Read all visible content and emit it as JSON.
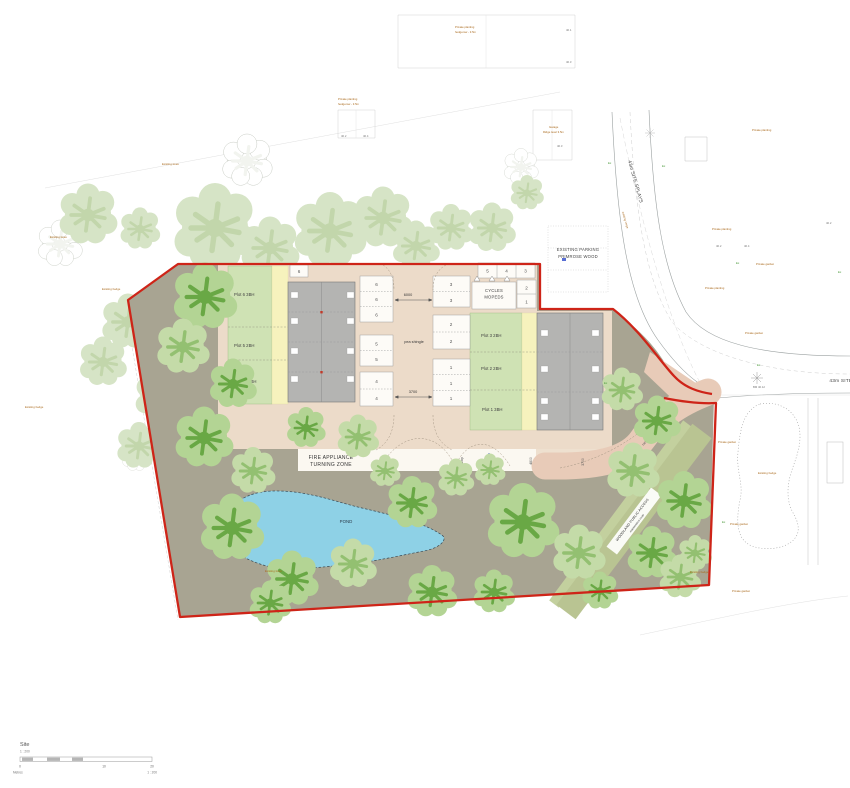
{
  "plan": {
    "fire_zone_line1": "FIRE APPLIANCE",
    "fire_zone_line2": "TURNING ZONE",
    "pond_label": "POND",
    "pea_shingle_court": "pea shingle",
    "pea_shingle_drive": "pea shingle",
    "cycles_line1": "CYCLES",
    "cycles_line2": "MOPEDS",
    "hardstanding_label": "hardstanding",
    "ramp_court": "ramp",
    "ramp_drive": "ramp",
    "fire_hydrant": "FH",
    "woodland_line1": "WOODLAND PUBLIC ACCESS",
    "woodland_line2": "maintenance route"
  },
  "plots": {
    "plot6": "Plot 6 3BH",
    "plot5": "Plot 5 2BH",
    "plot4": "Plot 4 2BH",
    "plot3": "Plot 3 2BH",
    "plot2": "Plot 2 2BH",
    "plot1": "Plot 1 3BH"
  },
  "parking": {
    "left": [
      "6",
      "6",
      "6",
      "5",
      "5",
      "4",
      "4"
    ],
    "right": [
      "3",
      "3",
      "2",
      "2",
      "1",
      "1",
      "1"
    ],
    "top": [
      "5",
      "4",
      "3"
    ],
    "side": [
      "2",
      "1"
    ],
    "corner": "6"
  },
  "dims": {
    "d6000": "6000",
    "d3700": "3700",
    "d4800": "4800",
    "d3700b": "3700",
    "d5500": "5500"
  },
  "roads": {
    "existing_parking_line1": "EXISTING PARKING",
    "existing_parking_line2": "PRIMROSE WOOD",
    "splays_top": "43m SITE SPLAYS",
    "splays_right": "43m SITE SP",
    "verge_note": "existing verge"
  },
  "notes": [
    {
      "t": "Private planting"
    },
    {
      "t": "hedgerow - 3.5m"
    },
    {
      "t": "Private planting"
    },
    {
      "t": "hedgerow - 3.5m"
    },
    {
      "t": "Garage"
    },
    {
      "t": "Ridge level 3.5m"
    },
    {
      "t": "Private planting"
    },
    {
      "t": "Private planting"
    },
    {
      "t": "Private garden"
    },
    {
      "t": "Private garden"
    },
    {
      "t": "Private garden"
    },
    {
      "t": "Existing hedge"
    },
    {
      "t": "Private garden"
    },
    {
      "t": "Existing hedge"
    },
    {
      "t": "Private garden"
    },
    {
      "t": "Existing hedge"
    },
    {
      "t": "Existing trees"
    },
    {
      "t": "Existing hedge"
    },
    {
      "t": "Existing trees"
    },
    {
      "t": "Existing trees"
    },
    {
      "t": "Private planting"
    }
  ],
  "levels": [
    "40.2",
    "40.4",
    "40.3",
    "40.2",
    "40.4",
    "40.1",
    "40.3",
    "40.2",
    "BM 40.12"
  ],
  "tree_tags": [
    "Ex",
    "Ex",
    "Ex",
    "Ex",
    "Ex",
    "Ex",
    "Ex"
  ],
  "scalebar": {
    "title": "Site",
    "ratio": "1 : 200",
    "metres": "Metres",
    "ratio_right": "1 : 200",
    "tick0": "0",
    "tick10": "10",
    "tick20": "20"
  },
  "colors": {
    "boundary_red": "#ce2418",
    "pond_blue": "#8ed1e6",
    "ground_olive": "#a8a492",
    "tree_green": "#69a845",
    "court_beige": "#ecdbc9"
  }
}
